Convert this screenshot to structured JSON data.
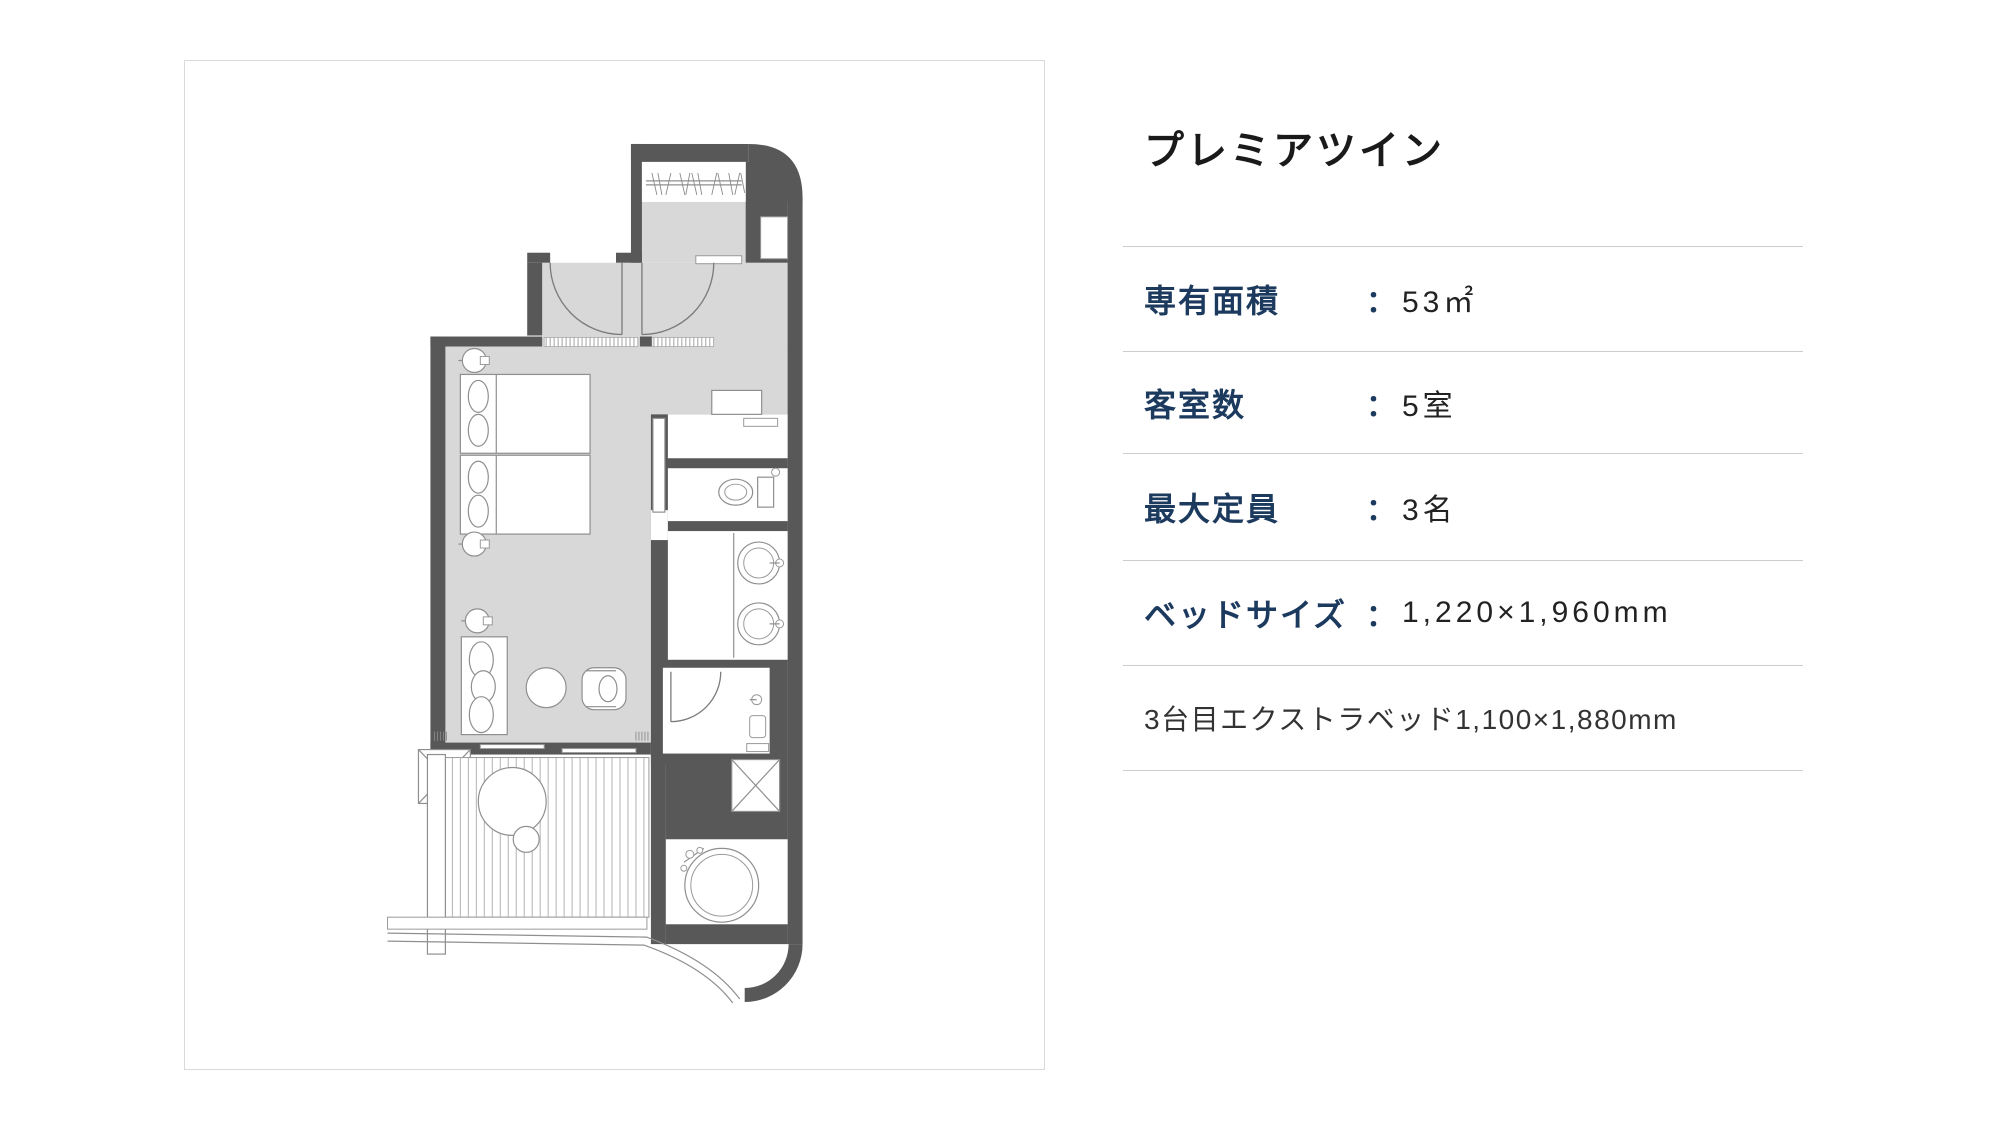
{
  "plan": {
    "description": "room-floor-plan",
    "wall_color": "#585858",
    "floor_color": "#d8d8d8",
    "fixture_line_color": "#8f8f8f"
  },
  "details": {
    "title": "プレミアツイン",
    "colon": "：",
    "rows": [
      {
        "label": "専有面積",
        "value": "53㎡"
      },
      {
        "label": "客室数",
        "value": "5室"
      },
      {
        "label": "最大定員",
        "value": "3名"
      },
      {
        "label": "ベッドサイズ",
        "value": "1,220×1,960mm"
      }
    ],
    "note": "3台目エクストラベッド1,100×1,880mm"
  }
}
